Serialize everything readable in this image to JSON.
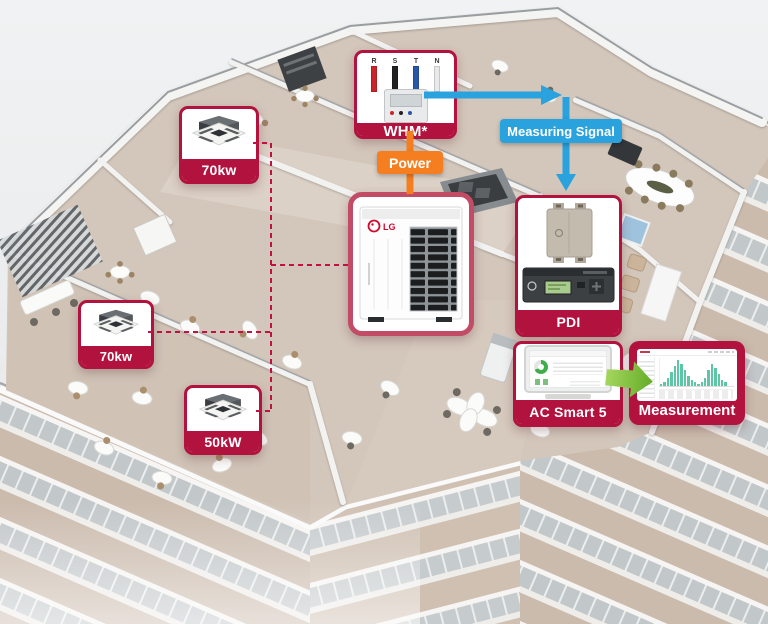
{
  "colors": {
    "crimson": "#b2123e",
    "crimsonBorder": "#c24b66",
    "orange": "#f57e20",
    "blue": "#29a2de",
    "green": "#84c341",
    "dashRed": "#c21140"
  },
  "diagram": {
    "indoor_units": [
      {
        "label": "70kw"
      },
      {
        "label": "70kw"
      },
      {
        "label": "50kW"
      }
    ],
    "whm": {
      "label": "WHM*",
      "wires": [
        {
          "label": "R",
          "color": "#c9252b"
        },
        {
          "label": "S",
          "color": "#222222"
        },
        {
          "label": "T",
          "color": "#2a56a8"
        },
        {
          "label": "N",
          "color": "#e9e9ec"
        }
      ]
    },
    "power": {
      "label": "Power"
    },
    "measuring_signal": {
      "label": "Measuring Signal"
    },
    "outdoor_unit": {
      "brand": "LG"
    },
    "pdi": {
      "label": "PDI"
    },
    "ac_smart": {
      "label": "AC Smart 5",
      "donut_percent": 68
    },
    "measurement": {
      "label": "Measurement",
      "chart": {
        "type": "bar",
        "values": [
          1,
          2,
          4,
          7,
          10,
          13,
          11,
          8,
          5,
          3,
          2,
          1,
          2,
          4,
          8,
          11,
          9,
          6,
          3,
          2
        ]
      }
    }
  }
}
